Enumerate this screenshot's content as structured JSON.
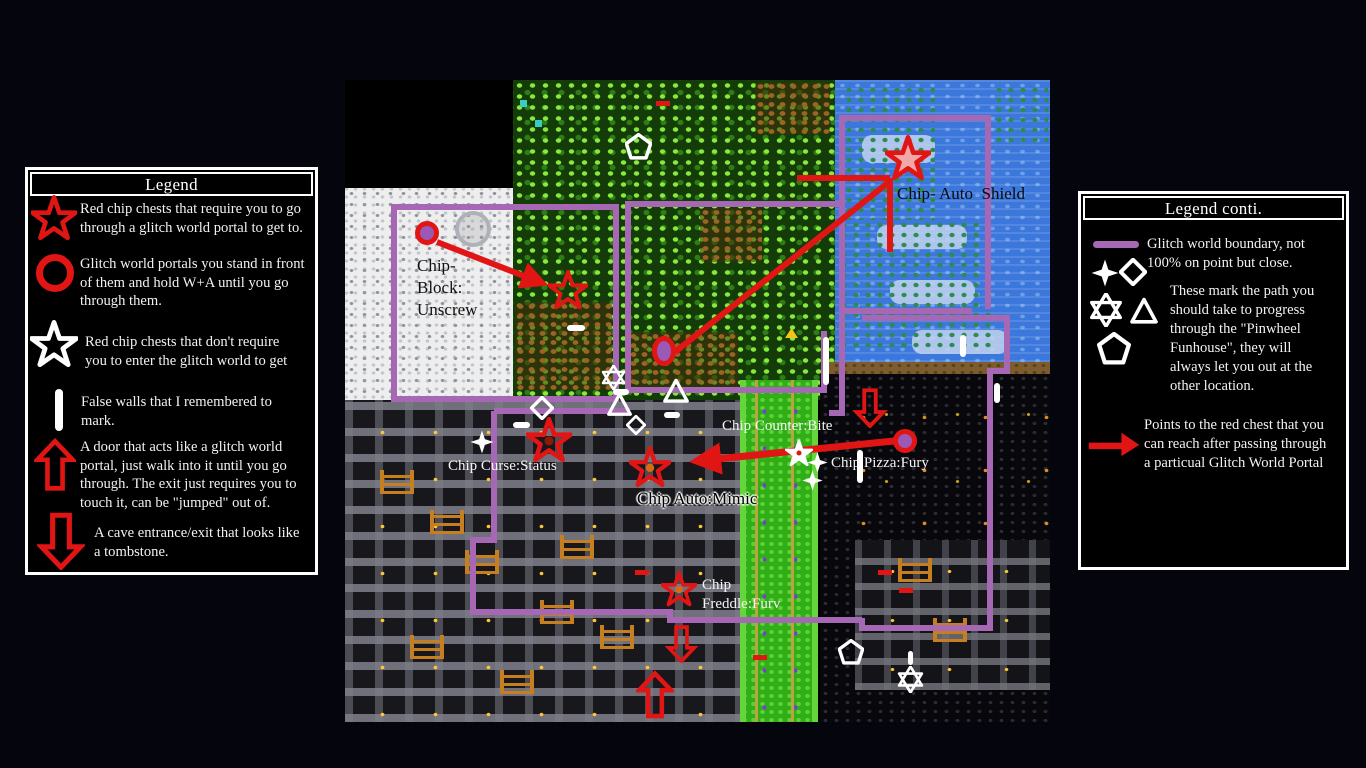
{
  "colors": {
    "boundary_purple": "#a667b4",
    "marker_red": "#e21515",
    "path_white": "#ffffff",
    "portal_fill": "#9b59b6"
  },
  "legend_left": {
    "title": "Legend",
    "items": [
      {
        "icon": "red-star-icon",
        "text": "Red chip chests that require you to go\nthrough a glitch world portal to get to."
      },
      {
        "icon": "red-circle-icon",
        "text": "Glitch world portals you stand in front\nof them and hold W+A until you go\nthrough them."
      },
      {
        "icon": "white-star-icon",
        "text": "Red chip chests that don't require\nyou to enter the glitch world to get"
      },
      {
        "icon": "white-bar-icon",
        "text": "False walls that I remembered to\nmark."
      },
      {
        "icon": "red-up-arrow-icon",
        "text": "A door that acts like a glitch world\nportal, just walk into it until you go\nthrough. The exit just requires you to\ntouch it, can be \"jumped\" out of."
      },
      {
        "icon": "red-down-arrow-icon",
        "text": "A cave entrance/exit that looks like\na tombstone."
      }
    ]
  },
  "legend_right": {
    "title": "Legend conti.",
    "items": [
      {
        "icon": "purple-line-icon",
        "text": "Glitch world boundary, not\n100% on point but close."
      },
      {
        "icon": "path-shape-icons",
        "text": "These mark the path you\nshould take to progress\nthrough the \"Pinwheel\nFunhouse\", they will\nalways let you out at the\nother location."
      },
      {
        "icon": "red-right-arrow-icon",
        "text": "Points to the red chest that you\ncan reach after passing through\na particual Glitch World Portal"
      }
    ]
  },
  "map": {
    "labels": [
      {
        "name": "label-chip-auto-shield",
        "text": "Chip- Auto  Shield",
        "x": 552,
        "y": 103,
        "color": "#0a0a0a",
        "size": 17,
        "halo": false,
        "lh": 21
      },
      {
        "name": "label-chip-block-unscrew",
        "text": "Chip-\nBlock:\nUnscrew",
        "x": 72,
        "y": 175,
        "color": "#111111",
        "size": 17,
        "halo": false,
        "lh": 22
      },
      {
        "name": "label-chip-counter-bite",
        "text": "Chip Counter:Bite",
        "x": 377,
        "y": 337,
        "color": "#f5f5f5",
        "size": 15,
        "halo": false,
        "lh": 19
      },
      {
        "name": "label-chip-pizza-fury",
        "text": "Chip Pizza:Fury",
        "x": 486,
        "y": 374,
        "color": "#f5f5f5",
        "size": 15,
        "halo": false,
        "lh": 19
      },
      {
        "name": "label-chip-curse-status",
        "text": "Chip Curse:Status",
        "x": 103,
        "y": 377,
        "color": "#f5f5f5",
        "size": 15,
        "halo": false,
        "lh": 19
      },
      {
        "name": "label-chip-auto-mimic",
        "text": "Chip Auto:Mimic",
        "x": 292,
        "y": 408,
        "color": "#000000",
        "size": 17,
        "halo": true,
        "lh": 21
      },
      {
        "name": "label-chip-freddle-furv",
        "text": "Chip\nFreddle:Furv",
        "x": 357,
        "y": 496,
        "color": "#f5f5f5",
        "size": 15,
        "halo": false,
        "lh": 19
      }
    ],
    "markers": [
      {
        "name": "red-chip-star",
        "x": 563,
        "y": 78,
        "size": 46,
        "fill": "#f2a8a8"
      },
      {
        "name": "red-chip-star",
        "x": 223,
        "y": 210,
        "size": 40
      },
      {
        "name": "red-chip-star",
        "x": 204,
        "y": 360,
        "size": 46,
        "dot": "#8a1a05"
      },
      {
        "name": "red-chip-star",
        "x": 305,
        "y": 387,
        "size": 42,
        "dot": "#d96a12"
      },
      {
        "name": "red-chip-star",
        "x": 334,
        "y": 509,
        "size": 36,
        "dot": "#d96a12"
      },
      {
        "name": "glitch-portal",
        "x": 82,
        "y": 153,
        "w": 24,
        "h": 24
      },
      {
        "name": "glitch-portal",
        "x": 319,
        "y": 271,
        "w": 24,
        "h": 30
      },
      {
        "name": "glitch-portal",
        "x": 560,
        "y": 361,
        "w": 24,
        "h": 24
      },
      {
        "name": "path-pentagon",
        "x": 293,
        "y": 66,
        "size": 27
      },
      {
        "name": "path-pentagon",
        "x": 506,
        "y": 572,
        "size": 26
      },
      {
        "name": "path-hexagram",
        "x": 268,
        "y": 297,
        "size": 25
      },
      {
        "name": "path-hexagram",
        "x": 565,
        "y": 599,
        "size": 27
      },
      {
        "name": "path-diamond",
        "x": 197,
        "y": 328,
        "size": 24
      },
      {
        "name": "path-diamond",
        "x": 291,
        "y": 345,
        "size": 20
      },
      {
        "name": "path-star4",
        "x": 137,
        "y": 362,
        "size": 24
      },
      {
        "name": "path-star4",
        "x": 472,
        "y": 382,
        "size": 21
      },
      {
        "name": "path-star4",
        "x": 467,
        "y": 400,
        "size": 21
      },
      {
        "name": "white-chip-star",
        "x": 454,
        "y": 373,
        "size": 28
      },
      {
        "name": "path-triangle",
        "x": 274,
        "y": 324,
        "size": 27
      },
      {
        "name": "path-triangle",
        "x": 331,
        "y": 311,
        "size": 28
      },
      {
        "name": "false-wall",
        "x": 231,
        "y": 248,
        "w": 18,
        "h": 6
      },
      {
        "name": "false-wall",
        "x": 176,
        "y": 345,
        "w": 17,
        "h": 6
      },
      {
        "name": "false-wall",
        "x": 327,
        "y": 335,
        "w": 16,
        "h": 6
      },
      {
        "name": "false-wall",
        "x": 276,
        "y": 312,
        "w": 16,
        "h": 6
      },
      {
        "name": "false-wall",
        "x": 481,
        "y": 281,
        "w": 6,
        "h": 48
      },
      {
        "name": "false-wall",
        "x": 618,
        "y": 266,
        "w": 6,
        "h": 22
      },
      {
        "name": "false-wall",
        "x": 652,
        "y": 313,
        "w": 6,
        "h": 20
      },
      {
        "name": "false-wall",
        "x": 515,
        "y": 386,
        "w": 6,
        "h": 33
      },
      {
        "name": "false-wall",
        "x": 565,
        "y": 578,
        "w": 5,
        "h": 14
      },
      {
        "name": "cave-arrow-down",
        "x": 525,
        "y": 328,
        "w": 36,
        "h": 40
      },
      {
        "name": "cave-arrow-down",
        "x": 336,
        "y": 564,
        "w": 33,
        "h": 38
      },
      {
        "name": "door-arrow-up",
        "x": 310,
        "y": 615,
        "w": 38,
        "h": 50
      }
    ],
    "boundaries": [
      "M49 127 H271 V319 H49 Z",
      "M283 310 V124 H497",
      "M283 310 H479 V251",
      "M497 124 V38 H643 V229",
      "M497 124 V333 H484",
      "M498 231 H627",
      "M517 238 H662 V291 H645 V548 H517 V538",
      "M149 331 H285",
      "M149 331 V460 H128 V532 H325 V540 H517"
    ],
    "arrows": [
      {
        "d": "M92 162 L197 203",
        "head": true,
        "w": 6
      },
      {
        "d": "M330 272 L544 102",
        "head": false,
        "w": 6
      },
      {
        "d": "M452 98 H545",
        "head": false,
        "w": 6
      },
      {
        "d": "M545 98 V172",
        "head": false,
        "w": 6
      },
      {
        "d": "M549 361 L352 381",
        "head": true,
        "w": 7
      }
    ]
  }
}
